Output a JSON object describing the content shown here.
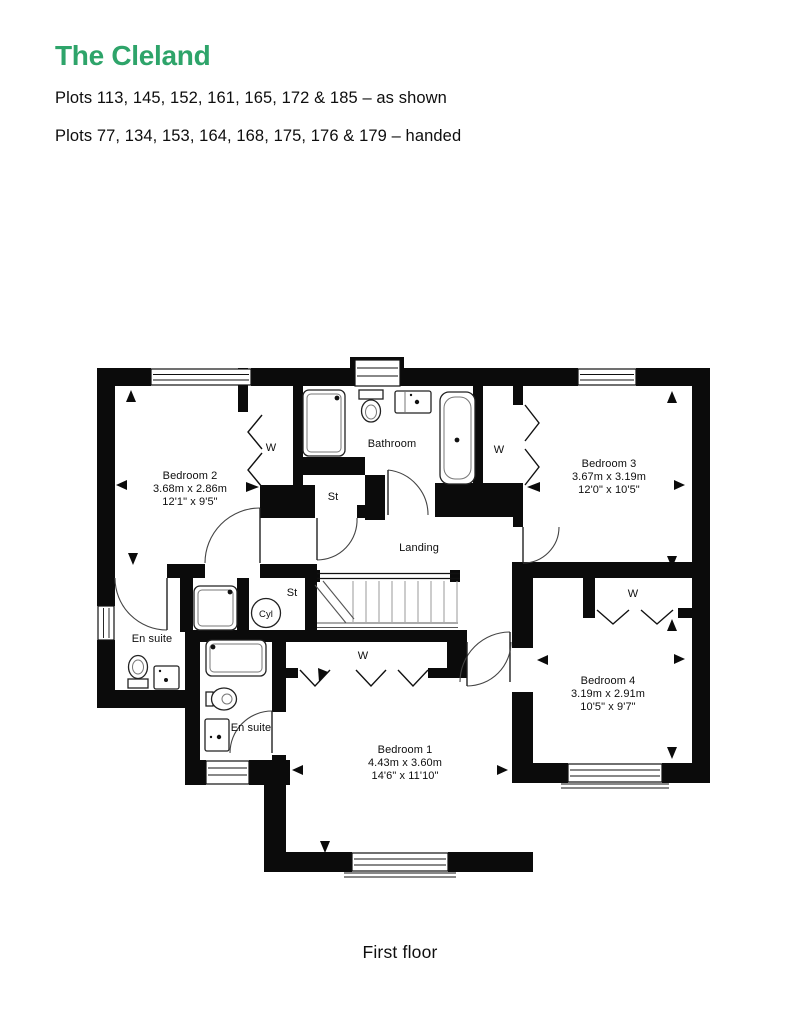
{
  "header": {
    "title": "The Cleland",
    "plots_line1": "Plots 113, 145, 152, 161, 165, 172 & 185 – as shown",
    "plots_line2": "Plots 77, 134, 153, 164, 168, 175, 176 & 179 – handed"
  },
  "floor_plan": {
    "caption": "First floor",
    "rooms": {
      "bedroom1": {
        "name": "Bedroom 1",
        "metric": "4.43m x 3.60m",
        "imperial": "14'6\" x 11'10\""
      },
      "bedroom2": {
        "name": "Bedroom 2",
        "metric": "3.68m x 2.86m",
        "imperial": "12'1\" x 9'5\""
      },
      "bedroom3": {
        "name": "Bedroom 3",
        "metric": "3.67m x 3.19m",
        "imperial": "12'0\" x 10'5\""
      },
      "bedroom4": {
        "name": "Bedroom 4",
        "metric": "3.19m x 2.91m",
        "imperial": "10'5\" x 9'7\""
      },
      "bathroom": {
        "name": "Bathroom"
      },
      "landing": {
        "name": "Landing"
      }
    },
    "labels": {
      "ensuite": "En suite",
      "store": "St",
      "cylinder": "Cyl",
      "wardrobe": "W"
    }
  },
  "colors": {
    "accent_green": "#2EA46A",
    "wall_black": "#0b0b0b"
  }
}
